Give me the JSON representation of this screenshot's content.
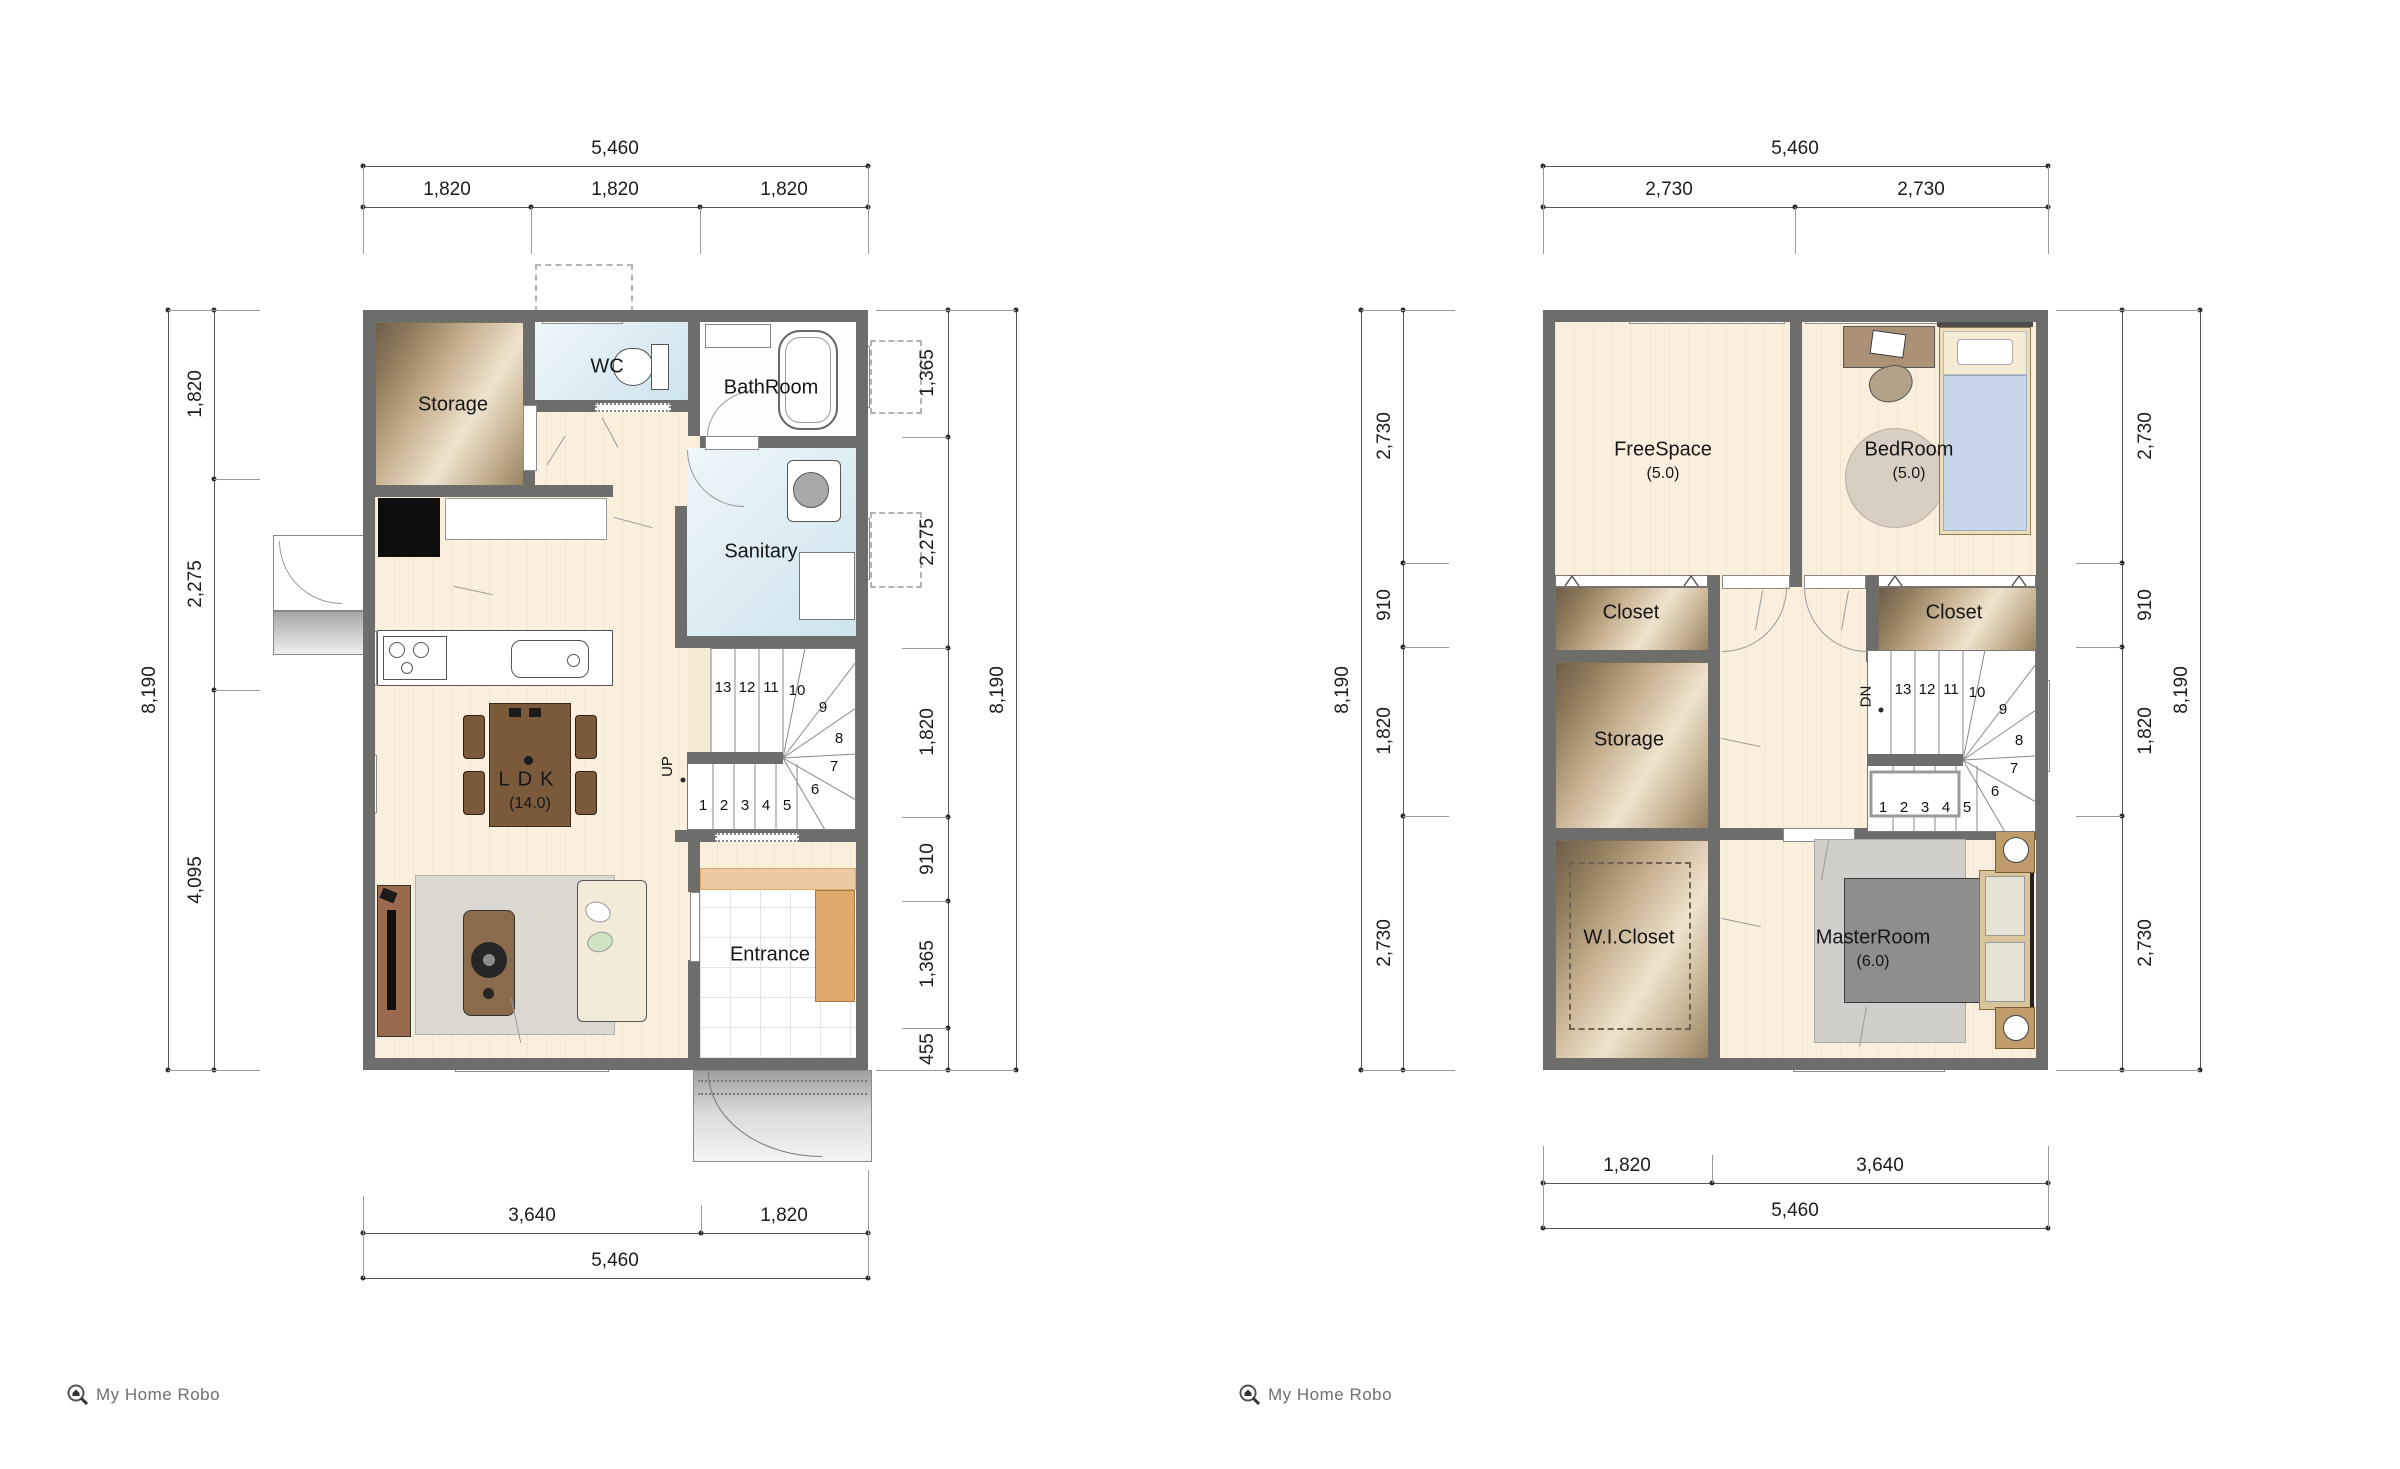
{
  "logo": {
    "text": "My Home Robo"
  },
  "stairs": {
    "numbers": [
      "1",
      "2",
      "3",
      "4",
      "5",
      "6",
      "7",
      "8",
      "9",
      "10",
      "11",
      "12",
      "13"
    ],
    "up": "UP",
    "down": "DN"
  },
  "colors": {
    "wall": "#6d6d6b",
    "floor_wood": "#f9efdc",
    "floor_wet": "#cde4ee",
    "closet_brown": "#93805f"
  },
  "floor1": {
    "rooms": {
      "storage": "Storage",
      "wc": "WC",
      "bathroom": "BathRoom",
      "sanitary": "Sanitary",
      "ldk": "LDK",
      "ldk_area": "(14.0)",
      "entrance": "Entrance"
    },
    "dims": {
      "top_total": "5,460",
      "top_segments": [
        "1,820",
        "1,820",
        "1,820"
      ],
      "left_total": "8,190",
      "left_segments": [
        "1,820",
        "2,275",
        "4,095"
      ],
      "right_total": "8,190",
      "right_segments": [
        "1,365",
        "2,275",
        "1,820",
        "910",
        "1,365",
        "455"
      ],
      "bottom_total": "5,460",
      "bottom_segments": [
        "3,640",
        "1,820"
      ]
    }
  },
  "floor2": {
    "rooms": {
      "freespace": "FreeSpace",
      "freespace_area": "(5.0)",
      "bedroom": "BedRoom",
      "bedroom_area": "(5.0)",
      "closet_left": "Closet",
      "closet_right": "Closet",
      "storage": "Storage",
      "wic": "W.I.Closet",
      "master": "MasterRoom",
      "master_area": "(6.0)"
    },
    "dims": {
      "top_total": "5,460",
      "top_segments": [
        "2,730",
        "2,730"
      ],
      "left_total": "8,190",
      "left_segments": [
        "2,730",
        "910",
        "1,820",
        "2,730"
      ],
      "right_total": "8,190",
      "right_segments": [
        "2,730",
        "910",
        "1,820",
        "2,730"
      ],
      "bottom_total": "5,460",
      "bottom_segments": [
        "1,820",
        "3,640"
      ]
    }
  }
}
